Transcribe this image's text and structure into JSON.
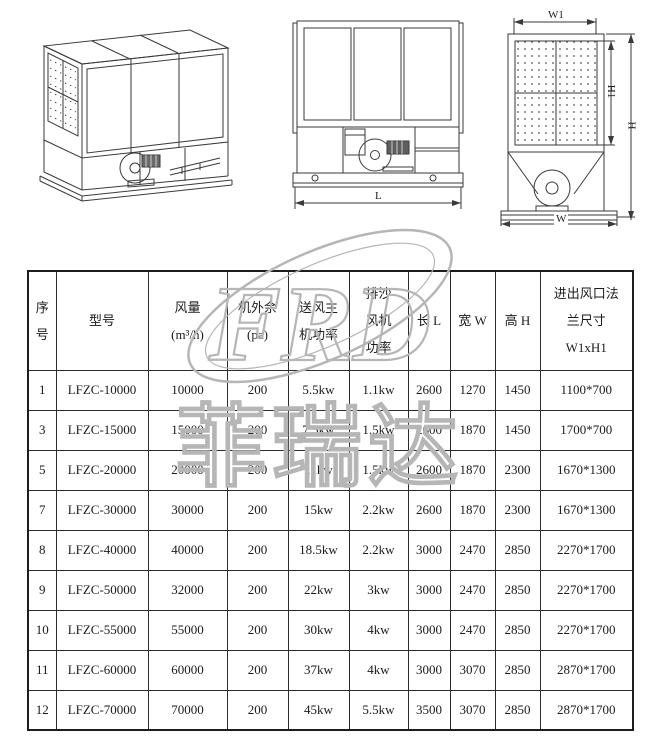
{
  "drawings": {
    "front": {
      "length_label": "L"
    },
    "side": {
      "w1": "W1",
      "h1": "H1",
      "h": "H",
      "w": "W"
    }
  },
  "watermark": {
    "letters": "FRD",
    "characters": "菲瑞达",
    "color": "#b6b6b6"
  },
  "table": {
    "headers": [
      {
        "lines": [
          "序",
          "号"
        ]
      },
      {
        "lines": [
          "型号"
        ]
      },
      {
        "lines": [
          "风量",
          "(m³/h)"
        ]
      },
      {
        "lines": [
          "机外余",
          "(pa)"
        ]
      },
      {
        "lines": [
          "送风主",
          "机功率"
        ]
      },
      {
        "lines": [
          "排沙",
          "风机",
          "功率"
        ]
      },
      {
        "lines": [
          "长 L"
        ]
      },
      {
        "lines": [
          "宽 W"
        ]
      },
      {
        "lines": [
          "高 H"
        ]
      },
      {
        "lines": [
          "进出风口法",
          "兰尺寸",
          "W1xH1"
        ]
      }
    ],
    "rows": [
      [
        "1",
        "LFZC-10000",
        "10000",
        "200",
        "5.5kw",
        "1.1kw",
        "2600",
        "1270",
        "1450",
        "1100*700"
      ],
      [
        "3",
        "LFZC-15000",
        "15000",
        "200",
        "7.5kw",
        "1.5kw",
        "2600",
        "1870",
        "1450",
        "1700*700"
      ],
      [
        "5",
        "LFZC-20000",
        "20000",
        "200",
        "11kw",
        "1.5kw",
        "2600",
        "1870",
        "2300",
        "1670*1300"
      ],
      [
        "7",
        "LFZC-30000",
        "30000",
        "200",
        "15kw",
        "2.2kw",
        "2600",
        "1870",
        "2300",
        "1670*1300"
      ],
      [
        "8",
        "LFZC-40000",
        "40000",
        "200",
        "18.5kw",
        "2.2kw",
        "3000",
        "2470",
        "2850",
        "2270*1700"
      ],
      [
        "9",
        "LFZC-50000",
        "32000",
        "200",
        "22kw",
        "3kw",
        "3000",
        "2470",
        "2850",
        "2270*1700"
      ],
      [
        "10",
        "LFZC-55000",
        "55000",
        "200",
        "30kw",
        "4kw",
        "3000",
        "2470",
        "2850",
        "2270*1700"
      ],
      [
        "11",
        "LFZC-60000",
        "60000",
        "200",
        "37kw",
        "4kw",
        "3000",
        "3070",
        "2850",
        "2870*1700"
      ],
      [
        "12",
        "LFZC-70000",
        "70000",
        "200",
        "45kw",
        "5.5kw",
        "3500",
        "3070",
        "2850",
        "2870*1700"
      ]
    ]
  }
}
